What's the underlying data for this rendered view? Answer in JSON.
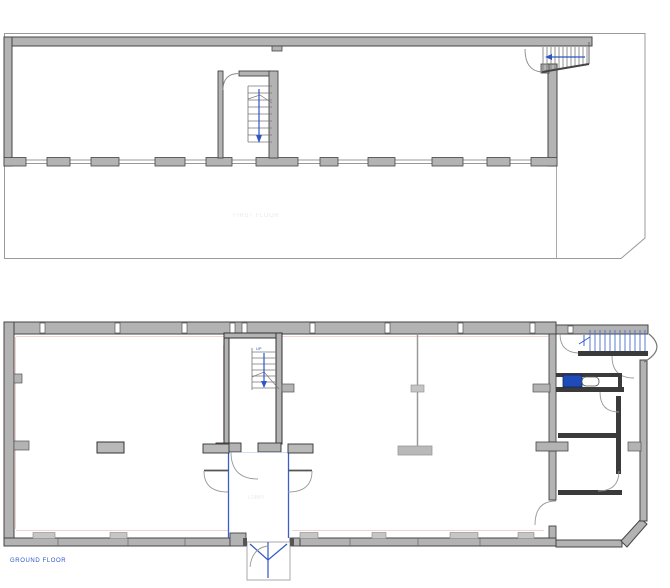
{
  "drawing": {
    "type": "architectural floor plan, two storeys",
    "labels": {
      "ground_floor": "GROUND FLOOR",
      "first_floor_faint": "FIRST FLOOR",
      "lobby_faint": "LOBBY",
      "stair_direction": "UP"
    },
    "colors": {
      "wall_fill": "#b3b3b3",
      "wall_edge": "#444444",
      "dark_wall": "#3a3a3a",
      "accent_blue": "#2f55c8",
      "stair_blue": "#4a6fd0",
      "survey_pink": "#f3d2d2",
      "outline_gray": "#999999",
      "cistern_blue": "#1e4bb8"
    }
  }
}
